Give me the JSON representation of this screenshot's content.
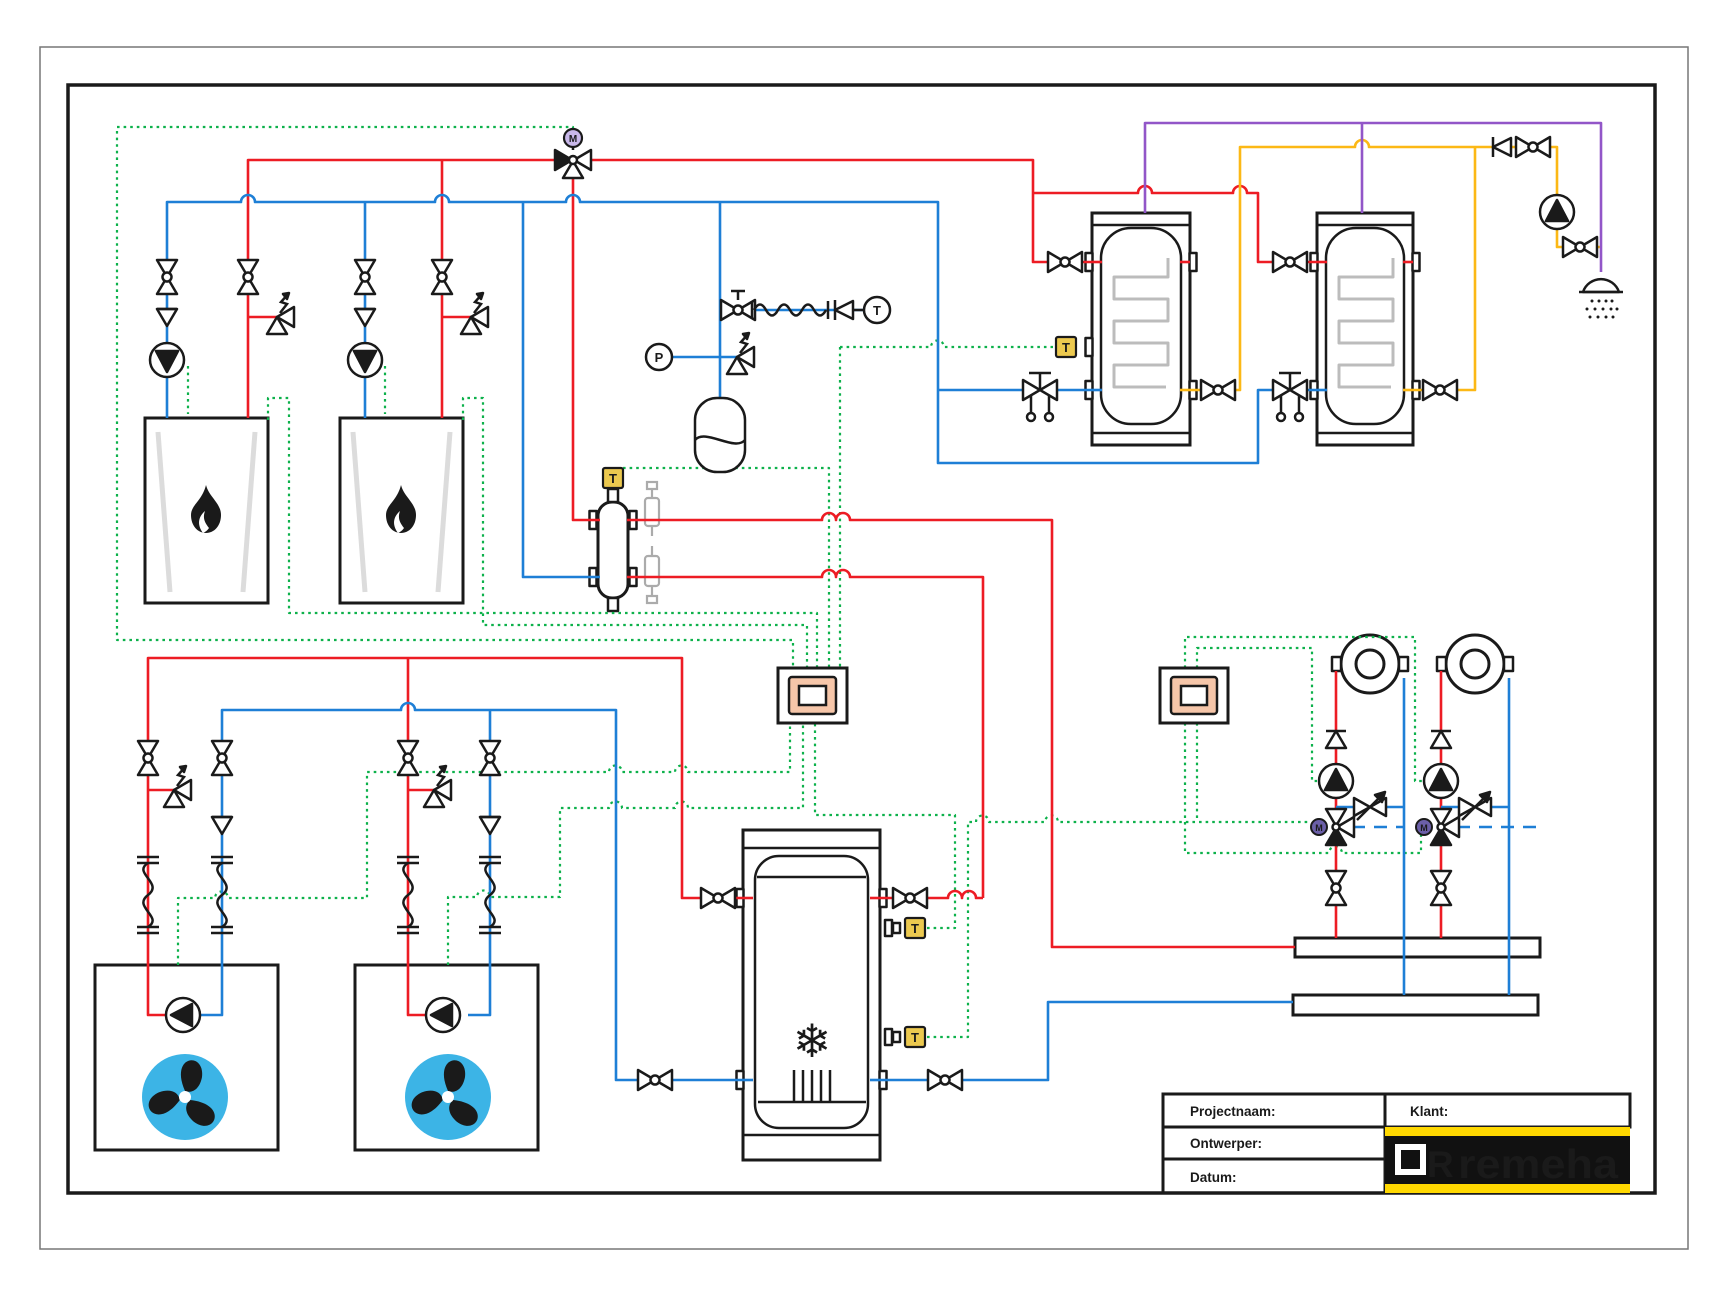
{
  "title_block": {
    "project_label": "Projectnaam:",
    "designer_label": "Ontwerper:",
    "date_label": "Datum:",
    "client_label": "Klant:"
  },
  "logo": {
    "brand": "remeha",
    "mark": "R"
  },
  "labels": {
    "temperature": "T",
    "pressure": "P",
    "motor": "M"
  },
  "icons": {
    "snowflake": "❄"
  },
  "colors": {
    "pipe_red": "#ed1c24",
    "pipe_blue": "#1e7fd6",
    "pipe_green": "#0db14b",
    "pipe_yellow": "#fcb815",
    "pipe_purple": "#9256c8",
    "fan_blue": "#3cb4e6",
    "controller_salmon": "#f6c6a9",
    "sensor_yellow": "#ecc94f",
    "logo_yellow": "#ffd800",
    "logo_black": "#111111",
    "line_black": "#1a1a1a",
    "grey_component": "#ababab",
    "coil_grey": "#bcbcbc"
  }
}
